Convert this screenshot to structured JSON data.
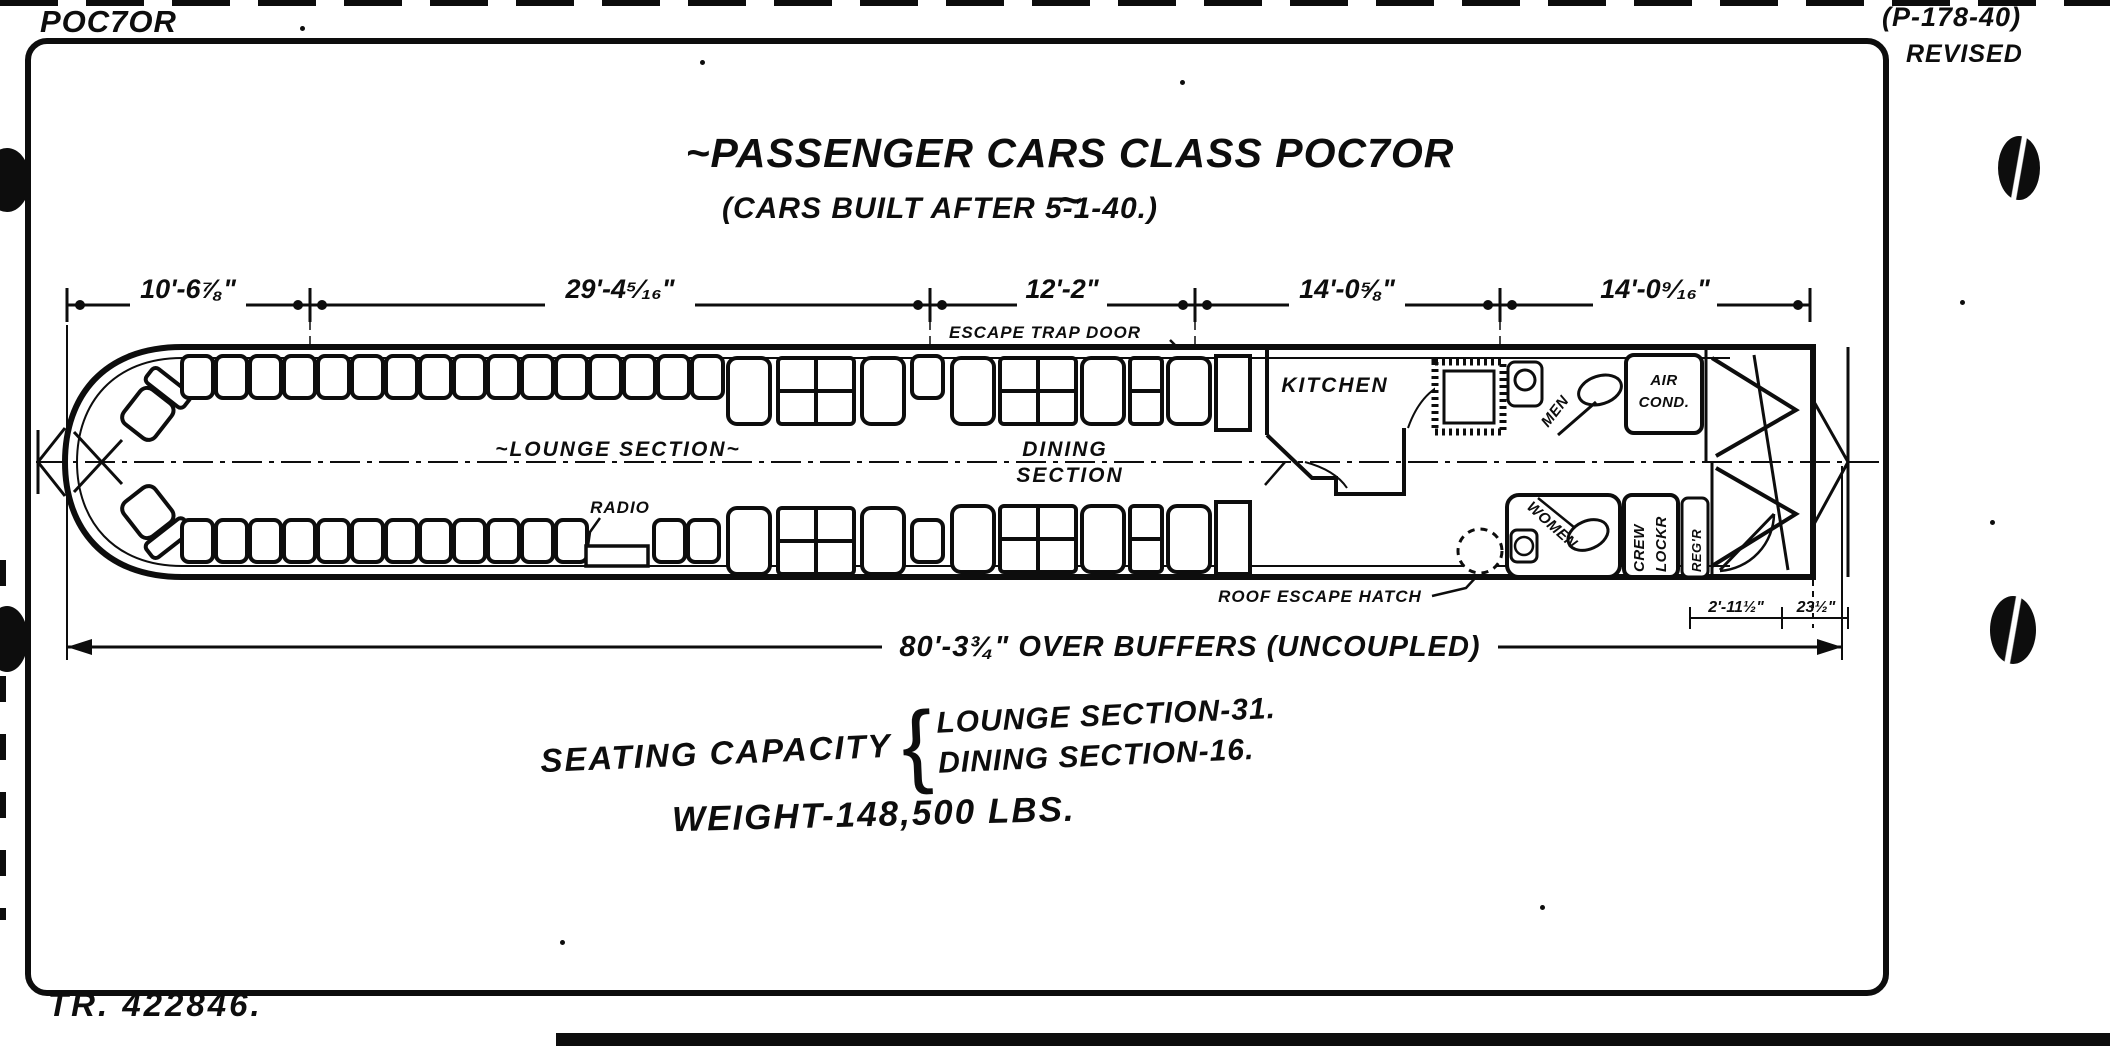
{
  "page": {
    "corner_class_label": "POC7OR",
    "drawing_number": "(P-178-40)",
    "revised_label": "REVISED",
    "tr_number": "TR. 422846.",
    "ink_color": "#0d0d0d",
    "paper_color": "#ffffff"
  },
  "title": {
    "main": "~PASSENGER CARS CLASS POC7OR ~",
    "subtitle": "(CARS BUILT AFTER 5-1-40.)"
  },
  "dimensions": {
    "segments": [
      {
        "label": "10'-6⅞\""
      },
      {
        "label": "29'-4⁵⁄₁₆\""
      },
      {
        "label": "12'-2\""
      },
      {
        "label": "14'-0⅝\""
      },
      {
        "label": "14'-0⁹⁄₁₆\""
      }
    ],
    "overall": "80'-3¾\" OVER BUFFERS (UNCOUPLED)",
    "vestibule_width": "2'-11½\"",
    "buffer_extension": "23½\""
  },
  "plan_labels": {
    "lounge_section": "~LOUNGE SECTION~",
    "dining_line1": "DINING",
    "dining_line2": "SECTION",
    "radio": "RADIO",
    "kitchen": "KITCHEN",
    "men": "MEN",
    "women": "WOMEN",
    "air_cond_line1": "AIR",
    "air_cond_line2": "COND.",
    "crew_line1": "CREW",
    "crew_line2": "LOCKR",
    "regr": "REG'R",
    "escape_trap_door": "ESCAPE TRAP DOOR",
    "roof_escape_hatch": "ROOF ESCAPE HATCH"
  },
  "notes": {
    "seating_capacity_label": "SEATING CAPACITY",
    "brace": "{",
    "lounge_capacity": "LOUNGE SECTION-31.",
    "dining_capacity": "DINING SECTION-16.",
    "weight": "WEIGHT-148,500 LBS."
  }
}
